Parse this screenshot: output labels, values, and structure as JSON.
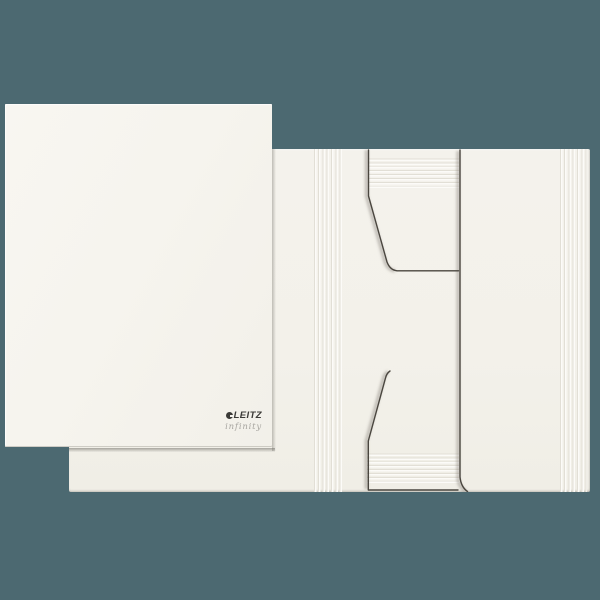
{
  "background_color": "#4c6971",
  "paper_color": "#f6f4ee",
  "front_cover": {
    "brand": "LEITZ",
    "series": "infinity"
  },
  "icons": {
    "brand_mark": "leitz-circle-icon"
  }
}
